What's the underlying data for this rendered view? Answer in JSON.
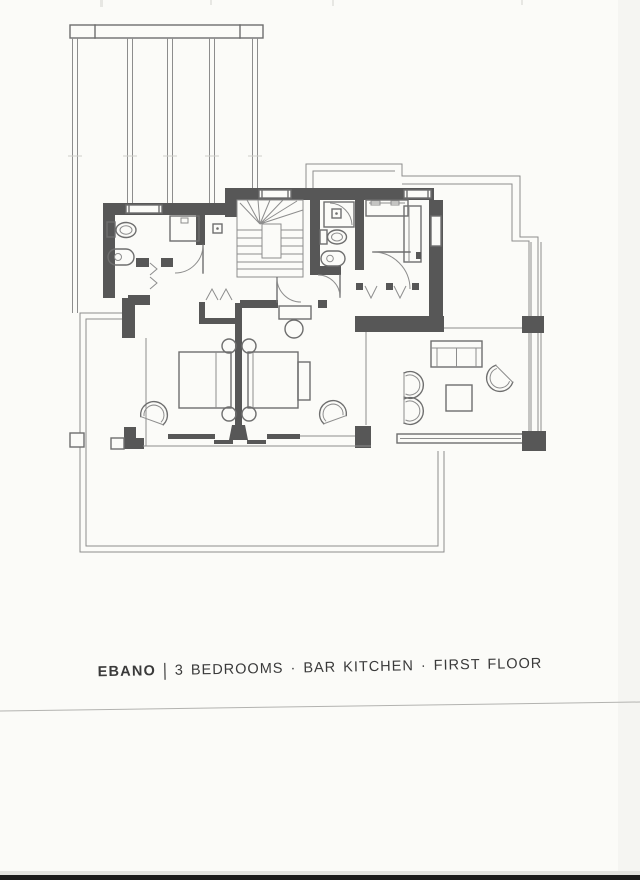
{
  "caption": {
    "project": "EBANO",
    "separator": "|",
    "description": "3 BEDROOMS · BAR KITCHEN · FIRST FLOOR"
  },
  "colors": {
    "paper": "#fbfbf8",
    "wall": "#575757",
    "line": "#6e6e6e",
    "thin": "#8d8d8d",
    "caption-text": "#3a3a3a",
    "scan-line": "#b3b3b0",
    "scan-bar": "#1b1b1b"
  }
}
